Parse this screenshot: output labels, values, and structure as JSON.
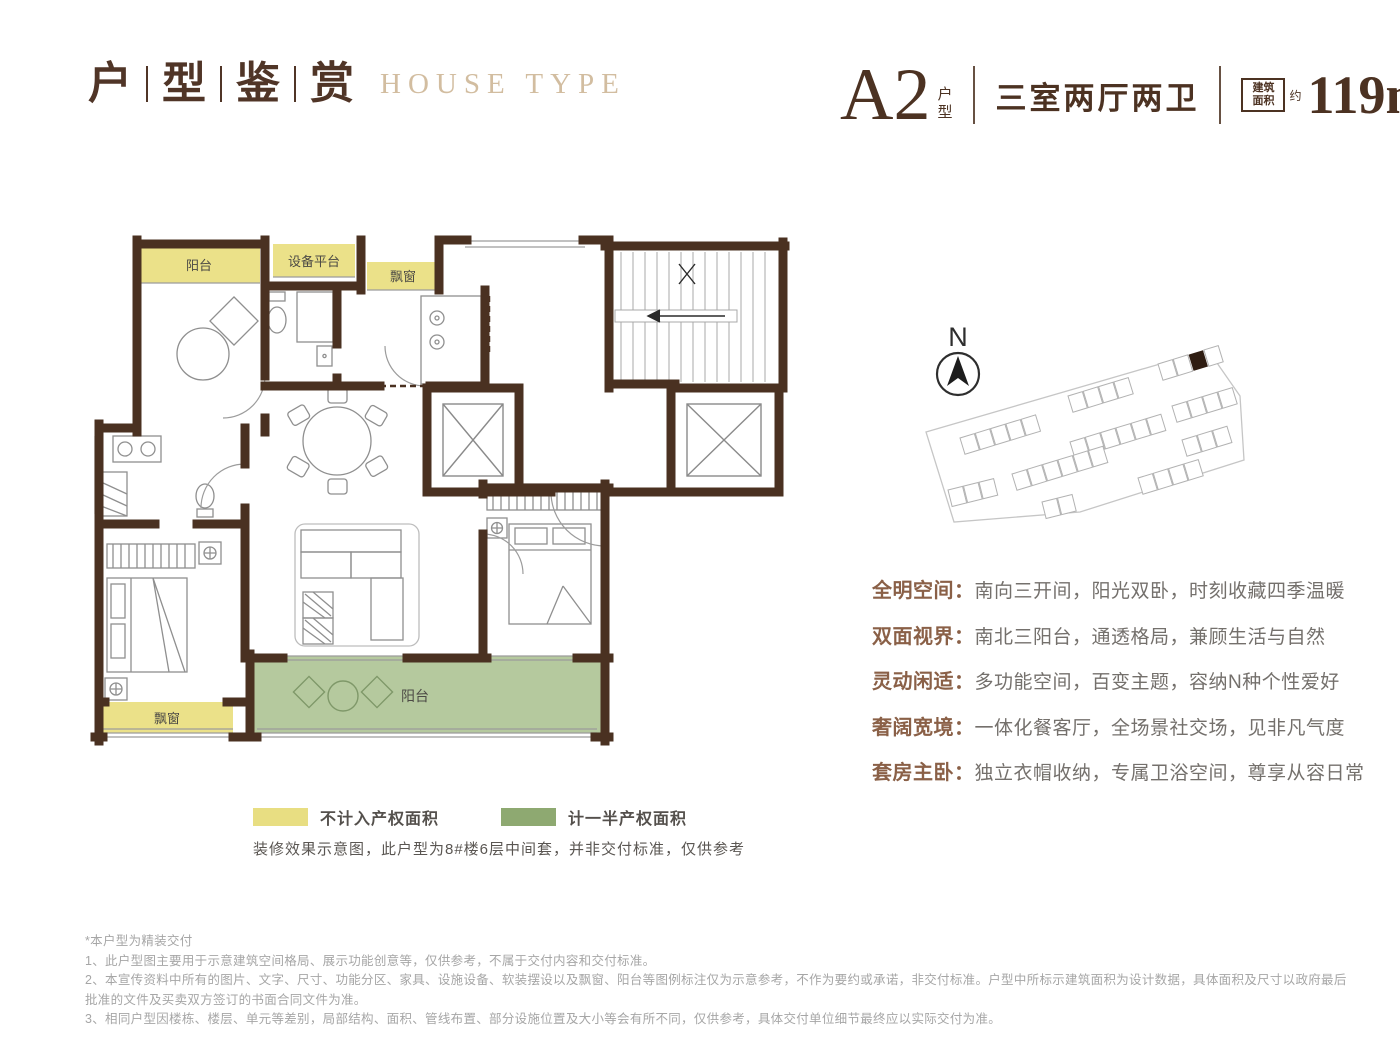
{
  "header": {
    "title_cn": [
      "户",
      "型",
      "鉴",
      "赏"
    ],
    "title_en": "HOUSE TYPE",
    "unit_code": "A2",
    "unit_code_suffix": "户型",
    "unit_layout": "三室两厅两卫",
    "area_badge_line1": "建筑",
    "area_badge_line2": "面积",
    "area_approx": "约",
    "area_value": "119m",
    "area_sup": "2"
  },
  "floorplan": {
    "labels": {
      "balcony_top": "阳台",
      "equipment_platform": "设备平台",
      "bay_window_top": "飘窗",
      "bay_window_bottom": "飘窗",
      "balcony_bottom": "阳台"
    },
    "colors": {
      "wall": "#4a3121",
      "no_property_area": "#ebe189",
      "half_property_area": "#b5c99e"
    }
  },
  "compass": {
    "label": "N"
  },
  "features": [
    {
      "label": "全明空间：",
      "text": "南向三开间，阳光双卧，时刻收藏四季温暖"
    },
    {
      "label": "双面视界：",
      "text": "南北三阳台，通透格局，兼顾生活与自然"
    },
    {
      "label": "灵动闲适：",
      "text": "多功能空间，百变主题，容纳N种个性爱好"
    },
    {
      "label": "奢阔宽境：",
      "text": "一体化餐客厅，全场景社交场，见非凡气度"
    },
    {
      "label": "套房主卧：",
      "text": "独立衣帽收纳，专属卫浴空间，尊享从容日常"
    }
  ],
  "legend": {
    "items": [
      {
        "color": "#e8de82",
        "label": "不计入产权面积"
      },
      {
        "color": "#8ea971",
        "label": "计一半产权面积"
      }
    ],
    "note": "装修效果示意图，此户型为8#楼6层中间套，并非交付标准，仅供参考"
  },
  "disclaimer": {
    "line0": "*本户型为精装交付",
    "line1": "1、此户型图主要用于示意建筑空间格局、展示功能创意等，仅供参考，不属于交付内容和交付标准。",
    "line2": "2、本宣传资料中所有的图片、文字、尺寸、功能分区、家具、设施设备、软装摆设以及飘窗、阳台等图例标注仅为示意参考，不作为要约或承诺，非交付标准。户型中所标示建筑面积为设计数据，具体面积及尺寸以政府最后批准的文件及买卖双方签订的书面合同文件为准。",
    "line3": "3、相同户型因楼栋、楼层、单元等差别，局部结构、面积、管线布置、部分设施位置及大小等会有所不同，仅供参考，具体交付单位细节最终应以实际交付为准。"
  }
}
